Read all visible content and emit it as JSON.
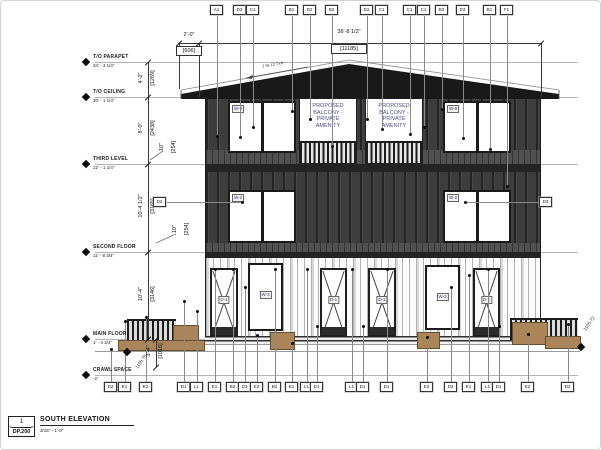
{
  "title_block": {
    "detail_number": "1",
    "sheet_number": "DP.200",
    "view_title": "SOUTH ELEVATION",
    "view_scale": "3/16\" - 1'-0\""
  },
  "levels": [
    {
      "name": "T/O PARAPET",
      "elev": "34' - 3 1/4\"",
      "y": 62
    },
    {
      "name": "T/O CEILING",
      "elev": "30' - 1 1/4\"",
      "y": 97
    },
    {
      "name": "THIRD LEVEL",
      "elev": "22' - 1 1/4\"",
      "y": 164
    },
    {
      "name": "SECOND FLOOR",
      "elev": "11' - 8 3/4\"",
      "y": 252
    },
    {
      "name": "MAIN FLOOR",
      "elev": "1' - 4 3/4\"",
      "y": 339
    },
    {
      "name": "CRAWL SPACE",
      "elev": "-2'",
      "y": 375
    }
  ],
  "vertical_dims": [
    {
      "ft": "4'-2\"",
      "mm": "[1269]",
      "cx": 147,
      "cy": 80
    },
    {
      "ft": "8'-0\"",
      "mm": "[2438]",
      "cx": 147,
      "cy": 130
    },
    {
      "ft": "10\"",
      "mm": "[254]",
      "cx": 168,
      "cy": 149
    },
    {
      "ft": "10'-4 1/2\"",
      "mm": "[3165]",
      "cx": 147,
      "cy": 208
    },
    {
      "ft": "10\"",
      "mm": "[254]",
      "cx": 181,
      "cy": 231
    },
    {
      "ft": "10'-4\"",
      "mm": "[3146]",
      "cx": 147,
      "cy": 296
    },
    {
      "ft": "3'-4\"",
      "mm": "[1016]",
      "cx": 155,
      "cy": 353
    }
  ],
  "horizontal_dims": {
    "overhang_ft": "2'-0\"",
    "overhang_mm": "[606]",
    "width_ft": "36'-8 1/2\"",
    "width_mm": "[11185]"
  },
  "top_callouts": [
    {
      "label": "A1",
      "x": 217,
      "end": 137
    },
    {
      "label": "D3",
      "x": 240,
      "end": 138
    },
    {
      "label": "C1",
      "x": 253,
      "end": 128
    },
    {
      "label": "B1",
      "x": 292,
      "end": 112
    },
    {
      "label": "D2",
      "x": 310,
      "end": 120
    },
    {
      "label": "B2",
      "x": 332,
      "end": 147
    },
    {
      "label": "D2",
      "x": 367,
      "end": 120
    },
    {
      "label": "C1",
      "x": 382,
      "end": 130
    },
    {
      "label": "C1",
      "x": 410,
      "end": 135
    },
    {
      "label": "C1",
      "x": 424,
      "end": 128
    },
    {
      "label": "B3",
      "x": 442,
      "end": 110
    },
    {
      "label": "D3",
      "x": 463,
      "end": 139
    },
    {
      "label": "B1",
      "x": 490,
      "end": 150
    },
    {
      "label": "F1",
      "x": 507,
      "end": 187
    }
  ],
  "bottom_callouts": [
    {
      "label": "D2",
      "x": 111,
      "end": 350
    },
    {
      "label": "E1",
      "x": 125,
      "end": 322
    },
    {
      "label": "E2",
      "x": 146,
      "end": 318
    },
    {
      "label": "D1",
      "x": 184,
      "end": 302
    },
    {
      "label": "L1",
      "x": 197,
      "end": 312
    },
    {
      "label": "E1",
      "x": 215,
      "end": 270
    },
    {
      "label": "B2",
      "x": 233,
      "end": 270
    },
    {
      "label": "D3",
      "x": 245,
      "end": 288
    },
    {
      "label": "E2",
      "x": 257,
      "end": 336
    },
    {
      "label": "B2",
      "x": 275,
      "end": 270
    },
    {
      "label": "E1",
      "x": 292,
      "end": 344
    },
    {
      "label": "L1",
      "x": 307,
      "end": 270
    },
    {
      "label": "D1",
      "x": 317,
      "end": 327
    },
    {
      "label": "L1",
      "x": 352,
      "end": 270
    },
    {
      "label": "D1",
      "x": 363,
      "end": 327
    },
    {
      "label": "D1",
      "x": 387,
      "end": 270
    },
    {
      "label": "E2",
      "x": 427,
      "end": 338
    },
    {
      "label": "D3",
      "x": 451,
      "end": 288
    },
    {
      "label": "E1",
      "x": 469,
      "end": 276
    },
    {
      "label": "L1",
      "x": 488,
      "end": 270
    },
    {
      "label": "D1",
      "x": 499,
      "end": 327
    },
    {
      "label": "E2",
      "x": 528,
      "end": 335
    },
    {
      "label": "D2",
      "x": 568,
      "end": 325
    }
  ],
  "side_callouts": [
    {
      "label": "D2",
      "x": 160,
      "y": 202,
      "ex": 242
    },
    {
      "label": "D3",
      "x": 546,
      "y": 202,
      "ex": 465
    }
  ],
  "tags": {
    "upper_window": "W-9",
    "mid_window": "W-2",
    "main_window": "W-3",
    "door": "D-1"
  },
  "balcony_note": [
    "PROPOSED",
    "BALCONY -",
    "PRIVATE",
    "AMENITY"
  ],
  "spot_elevations": {
    "left": "1105.78",
    "right": "1105.72"
  },
  "slope_note": "2 IN 12 TYP"
}
